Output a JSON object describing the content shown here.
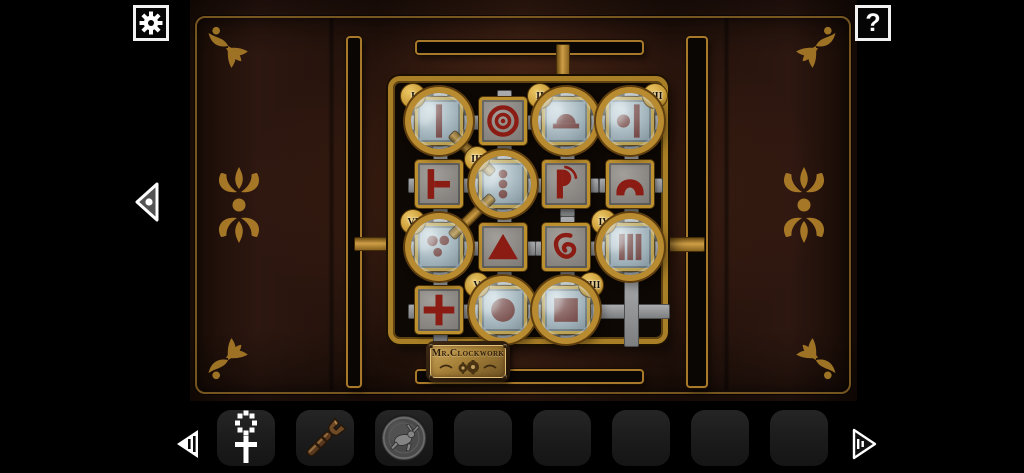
{
  "hud": {
    "settings_button": {
      "icon": "gear-icon"
    },
    "help_button": {
      "label": "?"
    },
    "back_arrow": {
      "icon": "triangle-left-icon"
    }
  },
  "room": {
    "plaque": {
      "text": "Mr.Clockwork"
    },
    "ornaments": [
      "corner-flourish x4",
      "fleur-de-lis-medallion x2"
    ]
  },
  "puzzle": {
    "grid": {
      "rows": 4,
      "cols": 4,
      "empty_cell": {
        "row": 4,
        "col": 4
      }
    },
    "tiles": [
      {
        "row": 1,
        "col": 1,
        "symbol": "vertical-bar",
        "lens": {
          "numeral": "I",
          "tag_side": "top-left"
        }
      },
      {
        "row": 1,
        "col": 2,
        "symbol": "concentric-circles",
        "lens": null
      },
      {
        "row": 1,
        "col": 3,
        "symbol": "dome-on-bar",
        "lens": {
          "numeral": "II",
          "tag_side": "top-left"
        }
      },
      {
        "row": 1,
        "col": 4,
        "symbol": "dot-and-bar",
        "lens": {
          "numeral": "VII",
          "tag_side": "top-right"
        }
      },
      {
        "row": 2,
        "col": 1,
        "symbol": "tee-right",
        "lens": null
      },
      {
        "row": 2,
        "col": 2,
        "symbol": "three-dots-column",
        "lens": {
          "numeral": "III",
          "tag_side": "top-left"
        }
      },
      {
        "row": 2,
        "col": 3,
        "symbol": "flag-p",
        "lens": null
      },
      {
        "row": 2,
        "col": 4,
        "symbol": "double-arch",
        "lens": null
      },
      {
        "row": 3,
        "col": 1,
        "symbol": "three-dots-triangle",
        "lens": {
          "numeral": "VI",
          "tag_side": "top-left"
        }
      },
      {
        "row": 3,
        "col": 2,
        "symbol": "triangle",
        "lens": null
      },
      {
        "row": 3,
        "col": 3,
        "symbol": "spiral",
        "lens": null
      },
      {
        "row": 3,
        "col": 4,
        "symbol": "three-bars",
        "lens": {
          "numeral": "IV",
          "tag_side": "top-left"
        }
      },
      {
        "row": 4,
        "col": 1,
        "symbol": "plus",
        "lens": null
      },
      {
        "row": 4,
        "col": 2,
        "symbol": "filled-circle",
        "lens": {
          "numeral": "V",
          "tag_side": "top-left"
        }
      },
      {
        "row": 4,
        "col": 3,
        "symbol": "filled-square",
        "lens": {
          "numeral": "VIII",
          "tag_side": "top-right"
        }
      },
      {
        "row": 4,
        "col": 4,
        "symbol": "empty",
        "lens": null
      }
    ]
  },
  "inventory": {
    "prev_arrow": {
      "icon": "arrow-left-icon"
    },
    "next_arrow": {
      "icon": "arrow-right-icon"
    },
    "slots": [
      {
        "item": "ankh-key"
      },
      {
        "item": "wrench"
      },
      {
        "item": "hare-coin"
      },
      {
        "item": null
      },
      {
        "item": null
      },
      {
        "item": null
      },
      {
        "item": null
      },
      {
        "item": null
      }
    ]
  },
  "colors": {
    "machine_gold": "#b98b30",
    "dark_gold": "#5e3e0f",
    "symbol_red": "#8b1c13",
    "lens_symbol_red": "#6e2d26",
    "wall_brown": "#3a1e12",
    "track_grey": "#8f9193",
    "glass_blue_grey": "#a9b8bf",
    "ornament_gold": "#a87b28"
  }
}
